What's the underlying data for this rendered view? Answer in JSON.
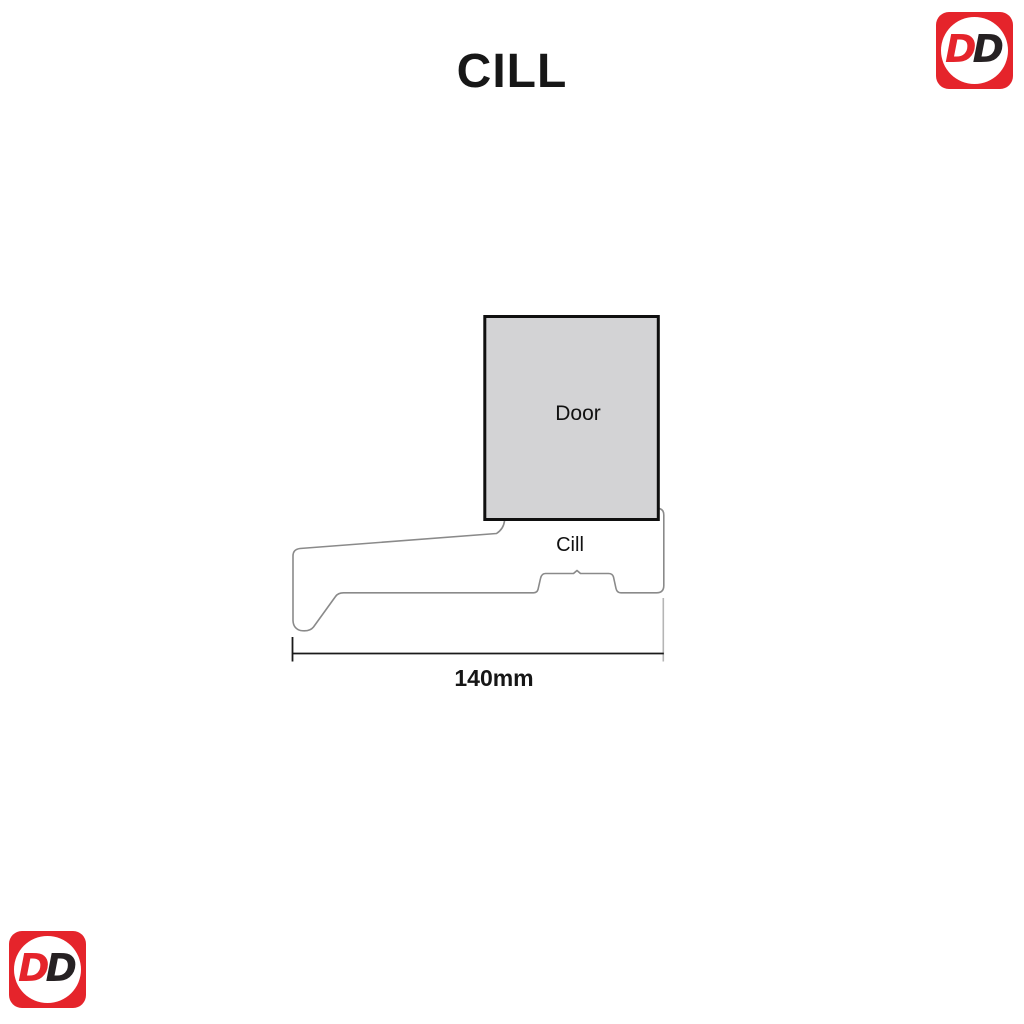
{
  "page": {
    "background_color": "#ffffff",
    "title": "CILL"
  },
  "logo": {
    "name": "DD",
    "d1": "D",
    "d2": "D",
    "square_color": "#e5242b",
    "circle_color": "#ffffff",
    "d1_color": "#e5242b",
    "d2_color": "#262123"
  },
  "diagram": {
    "door_label": "Door",
    "cill_label": "Cill",
    "dimension_label": "140mm",
    "dimension_value_mm": 140,
    "door_fill_color": "#d3d3d5",
    "door_border_color": "#0f0f0f",
    "profile_stroke_color": "#8a8a8a",
    "dimension_line_color": "#1a1a1a",
    "extension_line_color": "#b5b5b5"
  }
}
